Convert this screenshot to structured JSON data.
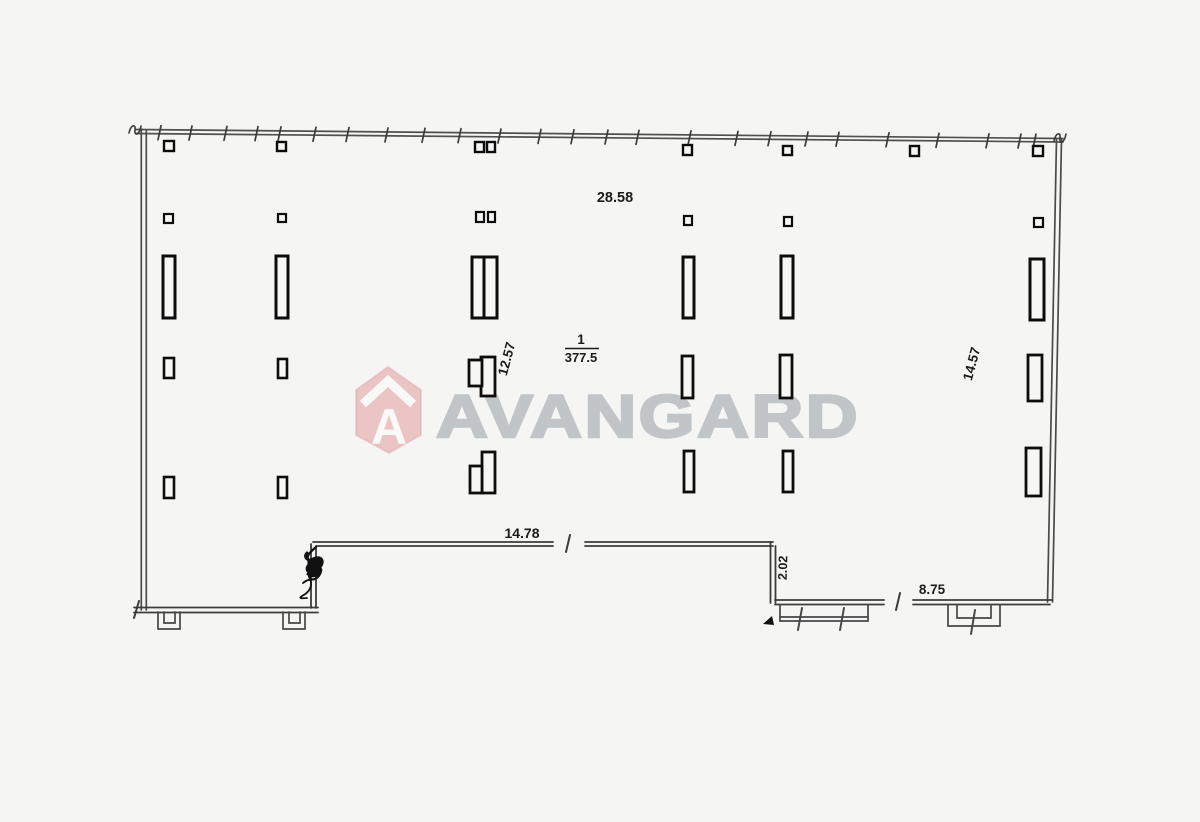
{
  "watermark": {
    "brand": "AVANGARD",
    "logo_letter": "A",
    "brand_red": "#cf4046",
    "text_gray": "#b5babd"
  },
  "room": {
    "number": "1",
    "area": "377.5"
  },
  "dimensions": {
    "top_width": "28.58",
    "interior_height_left": "12.57",
    "interior_height_right": "14.57",
    "bottom_middle_width": "14.78",
    "bottom_step_height": "2.02",
    "bottom_right_width": "8.75"
  }
}
